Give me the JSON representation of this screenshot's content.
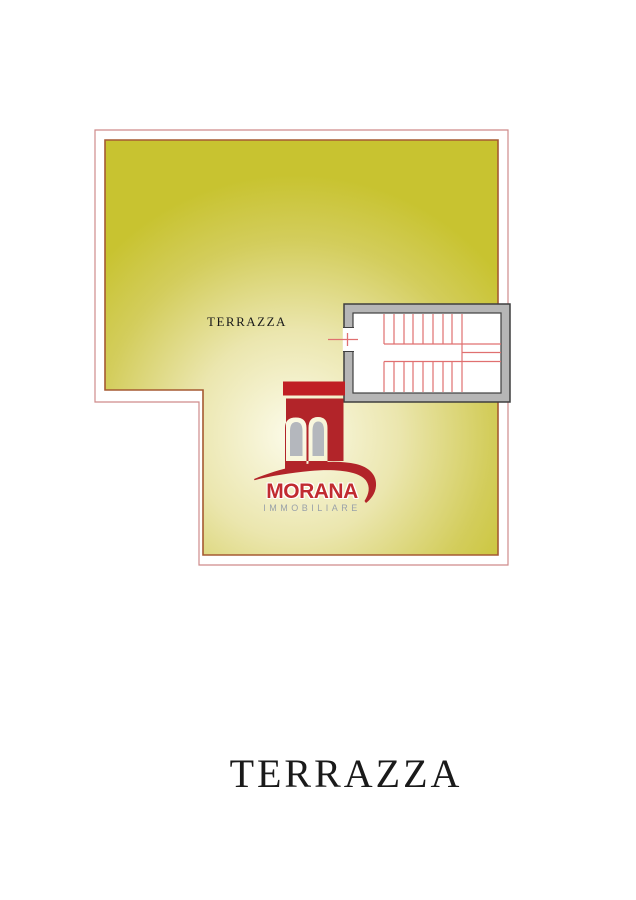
{
  "floorplan": {
    "room_label": "TERRAZZA"
  },
  "caption": {
    "title": "TERRAZZA"
  },
  "logo": {
    "name": "MORANA",
    "subtitle": "IMMOBILIARE"
  },
  "colors": {
    "page_bg": "#ffffff",
    "outer_border": "#cf8b8b",
    "plan_border": "#a55a32",
    "terrace_edge": "#c8c330",
    "terrace_mid": "#ebe6ae",
    "terrace_center": "#fcfbea",
    "wall_gray": "#b6b6b6",
    "wall_outline": "#3f3f3f",
    "stair_interior": "#ffffff",
    "stair_tread": "#e07070",
    "logo_red": "#b22429",
    "logo_cap_red": "#c01f24",
    "window_gray": "#b4b7bd",
    "brand_red": "#c12b30",
    "subtitle_gray": "#99a1a9",
    "label_ink": "#1a1a1a"
  }
}
